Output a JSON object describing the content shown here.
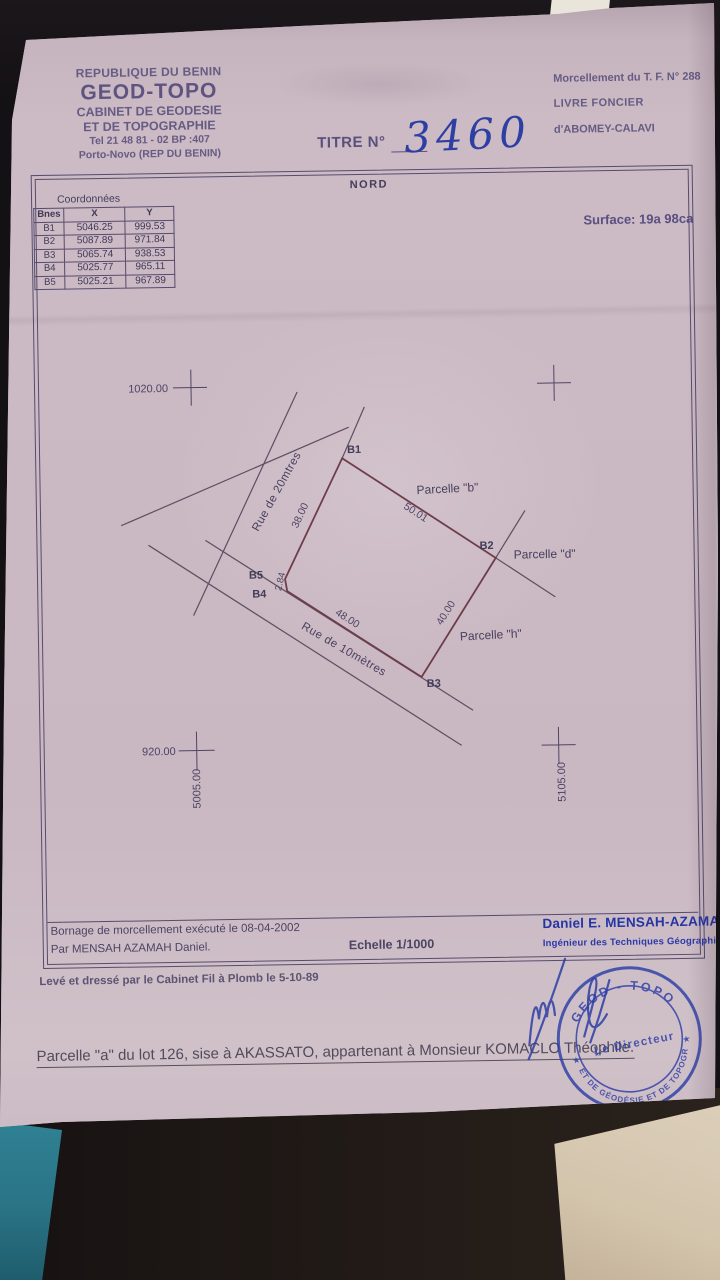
{
  "colors": {
    "paper": "#c7b5bf",
    "ink_purple": "#665b84",
    "plan_ink": "#4e4566",
    "parcel_line": "#6e3d49",
    "road_line": "#5d4f63",
    "ink_blue": "#2d3da6",
    "teal_strip": "#2f8294",
    "folder": "#d3c4ac"
  },
  "header_left": {
    "country": "REPUBLIQUE DU BENIN",
    "company": "GEOD-TOPO",
    "cabinet": "CABINET DE GEODESIE",
    "topographie": "ET DE TOPOGRAPHIE",
    "tel": "Tel 21 48 81 - 02 BP :407",
    "city": "Porto-Novo (REP DU BENIN)"
  },
  "header_right": {
    "morcellement": "Morcellement du T. F. N° 288",
    "livre_foncier": "LIVRE FONCIER",
    "commune": "d'ABOMEY-CALAVI"
  },
  "title": {
    "label": "TITRE N°",
    "number": "3460"
  },
  "plan": {
    "north_label": "NORD",
    "surface_label": "Surface: 19a 98ca",
    "grid_marks": {
      "top_left": "1020.00",
      "bottom_left": "920.00",
      "bottom_left_vertical": "5005.00",
      "bottom_right_vertical": "5105.00"
    },
    "vertices": {
      "b1": "B1",
      "b2": "B2",
      "b3": "B3",
      "b4": "B4",
      "b5": "B5"
    },
    "measurements": {
      "b5_b1": "38.00",
      "b1_b2": "50.01",
      "b2_b3": "40.00",
      "b4_b3": "48.00",
      "b4_b5": "2.84"
    },
    "parcel_labels": {
      "b": "Parcelle \"b\"",
      "d": "Parcelle \"d\"",
      "h": "Parcelle \"h\""
    },
    "street_labels": {
      "rue_20": "Rue de 20mtres",
      "rue_10": "Rue de 10mètres"
    }
  },
  "coordinates_table": {
    "title": "Coordonnées",
    "columns": [
      "Bnes",
      "X",
      "Y"
    ],
    "rows": [
      {
        "id": "B1",
        "x": "5046.25",
        "y": "999.53"
      },
      {
        "id": "B2",
        "x": "5087.89",
        "y": "971.84"
      },
      {
        "id": "B3",
        "x": "5065.74",
        "y": "938.53"
      },
      {
        "id": "B4",
        "x": "5025.77",
        "y": "965.11"
      },
      {
        "id": "B5",
        "x": "5025.21",
        "y": "967.89"
      }
    ]
  },
  "plan_footer": {
    "bornage": "Bornage de morcellement exécuté le 08-04-2002",
    "par": "Par MENSAH AZAMAH Daniel.",
    "echelle": "Echelle 1/1000",
    "engineer_name": "Daniel E. MENSAH-AZAMAH",
    "engineer_title": "Ingénieur des Techniques Géographiques"
  },
  "annotations": {
    "leve": "Levé et dressé par le Cabinet Fil à Plomb le 5-10-89",
    "parcel_statement": "Parcelle \"a\" du lot 126, sise à AKASSATO, appartenant à Monsieur KOMACLO Théophile."
  },
  "stamp": {
    "arc_top": "GEOD - TOPO",
    "arc_bottom": "CABINET DE GÉODÉSIE ET DE TOPOGRAPHIE",
    "center": "Le Directeur",
    "star": "★"
  }
}
